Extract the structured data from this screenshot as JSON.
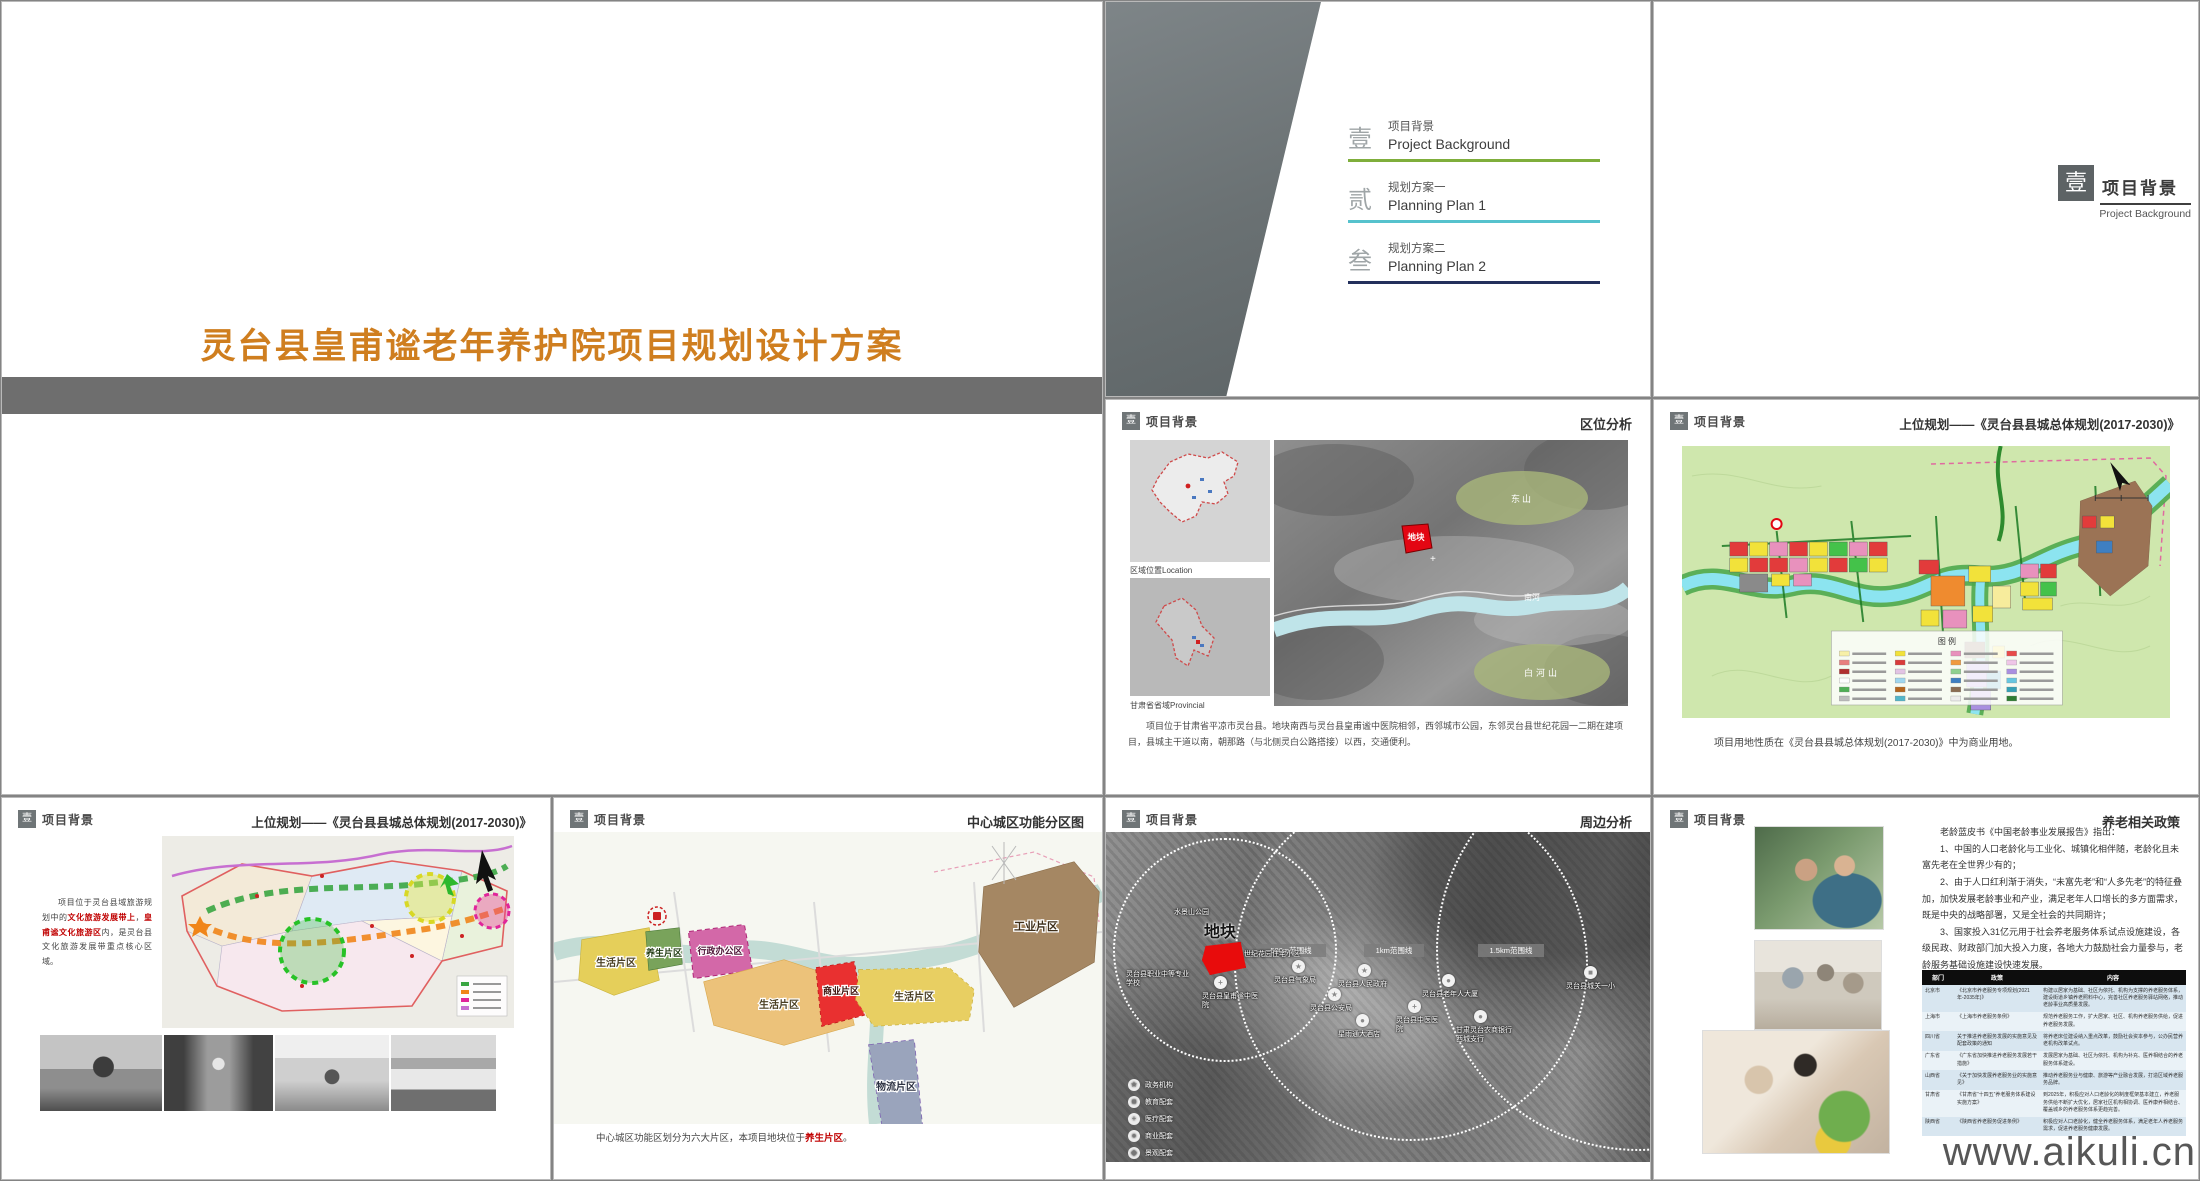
{
  "watermark": "www.aikuli.cn",
  "colors": {
    "title_orange": "#cf7e1f",
    "toc_green": "#7fae3b",
    "toc_teal": "#56c2cd",
    "toc_navy": "#23305c",
    "site_red": "#e80c0c",
    "highlight_red": "#c00000"
  },
  "slides": {
    "cover": {
      "title": "灵台县皇甫谧老年养护院项目规划设计方案"
    },
    "header": {
      "num": "壹",
      "label": "项目背景"
    },
    "toc": {
      "items": [
        {
          "num": "壹",
          "zh": "项目背景",
          "en": "Project Background"
        },
        {
          "num": "贰",
          "zh": "规划方案一",
          "en": "Planning Plan 1"
        },
        {
          "num": "叁",
          "zh": "规划方案二",
          "en": "Planning Plan 2"
        }
      ]
    },
    "divider": {
      "num": "壹",
      "zh": "项目背景",
      "en": "Project Background"
    },
    "location": {
      "title": "区位分析",
      "cap_china": "区域位置Location",
      "cap_gansu": "甘肃省省域Provincial",
      "label_east": "东山",
      "label_south": "白河山",
      "label_river": "南河",
      "label_site": "地块",
      "body": "项目位于甘肃省平凉市灵台县。地块南西与灵台县皇甫谧中医院相邻，西邻城市公园，东邻灵台县世纪花园一二期在建项目，县城主干道以南，朝那路（与北侧灵白公路搭接）以西，交通便利。"
    },
    "master": {
      "title": "上位规划——《灵台县县城总体规划(2017-2030)》",
      "legend_title": "图 例",
      "caption": "项目用地性质在《灵台县县城总体规划(2017-2030)》中为商业用地。"
    },
    "tourism": {
      "title": "上位规划——《灵台县县城总体规划(2017-2030)》",
      "t1": "项目位于灵台县域旅游规划中的",
      "r1": "文化旅游发展带上",
      "t2": "，",
      "r2": "皇甫谧文化旅游区",
      "t3": "内，是灵台县文化旅游发展带重点核心区域。"
    },
    "zoning": {
      "title": "中心城区功能分区图",
      "zones": [
        "生活片区",
        "养生片区",
        "行政办公区",
        "生活片区",
        "商业片区",
        "生活片区",
        "工业片区",
        "物流片区"
      ],
      "cap1": "中心城区功能区划分为六大片区，本项目地块位于",
      "capr": "养生片区",
      "cap2": "。"
    },
    "surround": {
      "title": "周边分析",
      "site": "地块",
      "rings": [
        "500m范围线",
        "1km范围线",
        "1.5km范围线"
      ],
      "pois": [
        "水景山公园",
        "世纪花园住宅小区",
        "灵台县职业中等专业学校",
        "灵台县皇甫谧中医院",
        "灵台县气象局",
        "灵台县人民政府",
        "灵台县公安局",
        "星雨通大酒店",
        "灵台县中医医院",
        "灵台县老年人大厦",
        "甘肃灵台农商银行西城支行",
        "灵台县城关一小"
      ],
      "legend": [
        "政务机构",
        "教育配套",
        "医疗配套",
        "商业配套",
        "景观配套"
      ]
    },
    "policy": {
      "title": "养老相关政策",
      "p0": "老龄蓝皮书《中国老龄事业发展报告》指出：",
      "p1": "1、中国的人口老龄化与工业化、城镇化相伴随，老龄化且未富先老在全世界少有的；",
      "p2": "2、由于人口红利渐于消失，“未富先老”和“人多先老”的特征叠加，加快发展老龄事业和产业，满足老年人口增长的多方面需求，既是中央的战略部署，又是全社会的共同期许；",
      "p3": "3、国家投入31亿元用于社会养老服务体系试点设施建设，各级民政、财政部门加大投入力度，各地大力鼓励社会力量参与，老龄服务基础设施建设快速发展。",
      "table": {
        "headers": [
          "部门",
          "政策",
          "内容"
        ],
        "rows": [
          [
            "北京市",
            "《北京市养老服务专项规划(2021年-2035年)》",
            "构建以居家为基础、社区为依托、机构为支撑的养老服务体系，建设街道乡镇养老照料中心，完善社区养老服务驿站网络，推动老龄事业高质量发展。"
          ],
          [
            "上海市",
            "《上海市养老服务条例》",
            "规范养老服务工作，扩大居家、社区、机构养老服务供给，促进养老服务发展。"
          ],
          [
            "四川省",
            "关于推进养老服务发展的实施意见及配套政策的通知",
            "将养老床位建设纳入重点改革，鼓励社会资本参与，公办民营养老机构改革试点。"
          ],
          [
            "广东省",
            "《广东省加快推进养老服务发展若干措施》",
            "发展居家为基础、社区为依托、机构为补充、医养相结合的养老服务体系建设。"
          ],
          [
            "山西省",
            "《关于加快发展养老服务业的实施意见》",
            "推动养老服务业与健康、旅游等产业融合发展，打造区域养老服务品牌。"
          ],
          [
            "甘肃省",
            "《甘肃省“十四五”养老服务体系建设实施方案》",
            "到2025年，积极应对人口老龄化的制度框架基本建立，养老服务供给不断扩大优化，居家社区机构相协调、医养康养相结合、覆盖城乡的养老服务体系更趋完善。"
          ],
          [
            "陕西省",
            "《陕西省养老服务促进条例》",
            "积极应对人口老龄化，健全养老服务体系，满足老年人养老服务需求，促进养老服务健康发展。"
          ]
        ]
      }
    }
  }
}
